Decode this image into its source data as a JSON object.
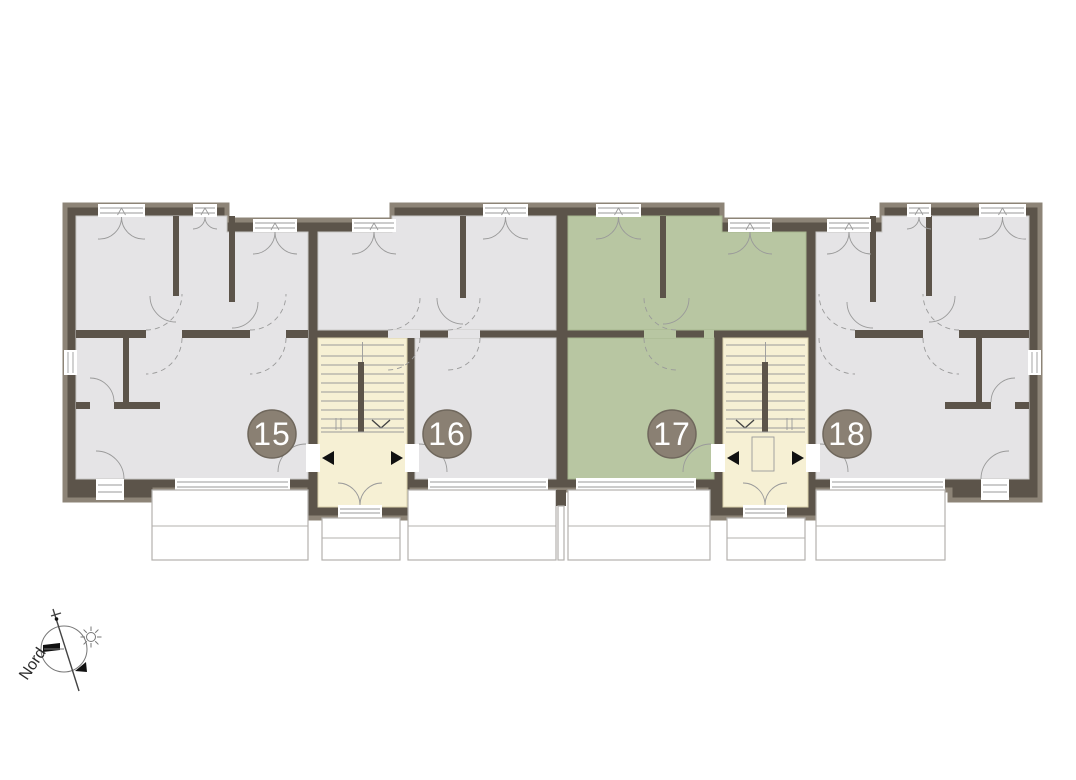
{
  "plan": {
    "title": "floor-plan",
    "units": [
      {
        "id": "15",
        "label": "15",
        "highlighted": false
      },
      {
        "id": "16",
        "label": "16",
        "highlighted": false
      },
      {
        "id": "17",
        "label": "17",
        "highlighted": true
      },
      {
        "id": "18",
        "label": "18",
        "highlighted": false
      }
    ],
    "compass": {
      "label": "Nord"
    },
    "colors": {
      "wall": "#5c544a",
      "wall_outer": "#8d8477",
      "floor": "#e5e4e6",
      "highlight": "#b8c6a2",
      "stair": "#f6f0d4",
      "badge": "#8a8073",
      "line": "#9a9a9a",
      "balcony": "#b3b1ae",
      "paper": "#ffffff"
    }
  }
}
